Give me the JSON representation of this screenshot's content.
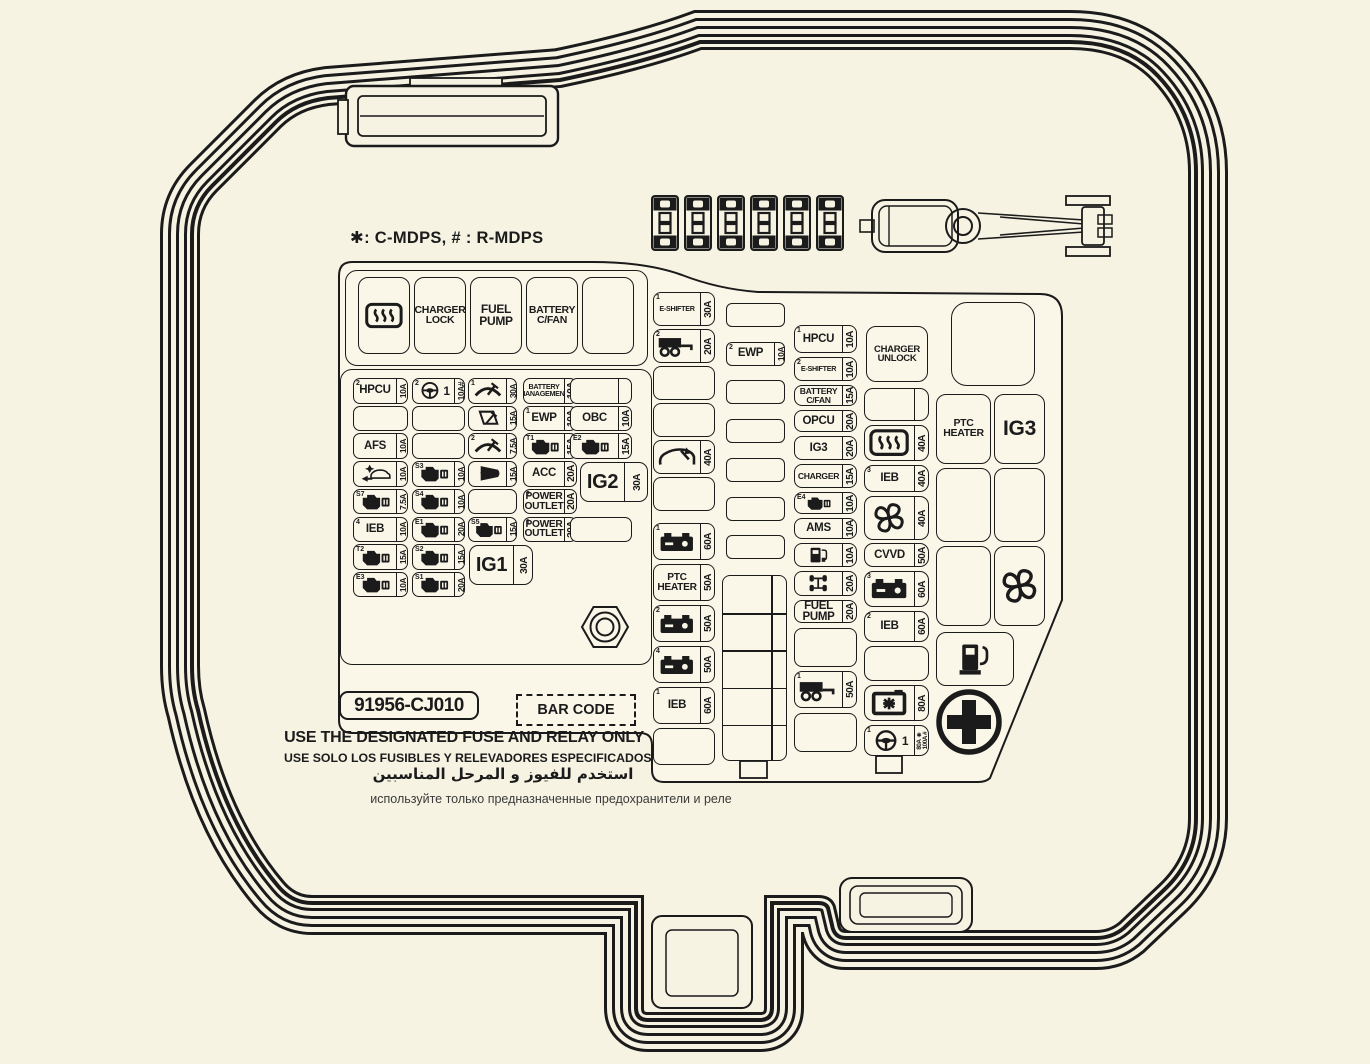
{
  "legend": "✱:  C-MDPS, # : R-MDPS",
  "colors": {
    "background": "#f6f3e3",
    "panel": "#faf7e9",
    "line": "#1b1b1b"
  },
  "hardware": {
    "spare_fuses": 6,
    "has_fuse_puller": true
  },
  "relay_row": [
    {
      "icon": "defrost-icon"
    },
    {
      "label": "CHARGER\nLOCK"
    },
    {
      "label": "FUEL\nPUMP"
    },
    {
      "label": "BATTERY\nC/FAN"
    },
    null
  ],
  "left_grid": {
    "rows": [
      [
        {
          "sup": "2",
          "label": "HPCU",
          "amp": "10A"
        },
        {
          "sup": "2",
          "icon": "steering-wheel-icon",
          "text": "1",
          "amp": "10A#"
        },
        {
          "sup": "1",
          "icon": "wiper-icon",
          "amp": "30A"
        },
        {
          "label": "BATTERY\nMANAGEMENT",
          "amp": "10A"
        },
        {
          "div": true
        }
      ],
      [
        null,
        null,
        {
          "icon": "rear-wiper-icon",
          "amp": "15A"
        },
        {
          "sup": "1",
          "label": "EWP",
          "amp": "10A"
        },
        {
          "label": "OBC",
          "amp": "10A"
        }
      ],
      [
        {
          "label": "AFS",
          "amp": "10A"
        },
        null,
        {
          "sup": "2",
          "icon": "wiper-icon",
          "amp": "7.5A"
        },
        {
          "sup": "T1",
          "icon": "ecu-icon",
          "amp": "15A"
        },
        {
          "sup": "E2",
          "icon": "ecu-icon",
          "amp": "15A"
        }
      ],
      [
        {
          "icon": "aeb-icon",
          "amp": "10A"
        },
        {
          "sup": "S3",
          "icon": "ecu-icon",
          "amp": "10A"
        },
        {
          "icon": "horn-icon",
          "amp": "15A"
        },
        {
          "label": "ACC",
          "amp": "20A"
        },
        null
      ],
      [
        {
          "sup": "S7",
          "icon": "ecu-icon",
          "amp": "7.5A"
        },
        {
          "sup": "S4",
          "icon": "ecu-icon",
          "amp": "10A"
        },
        null,
        {
          "sup": "2",
          "label": "POWER\nOUTLET",
          "amp": "20A"
        },
        null
      ],
      [
        {
          "sup": "4",
          "label": "IEB",
          "amp": "10A"
        },
        {
          "sup": "E1",
          "icon": "ecu-icon",
          "amp": "20A"
        },
        {
          "sup": "S5",
          "icon": "ecu-icon",
          "amp": "15A"
        },
        {
          "sup": "1",
          "label": "POWER\nOUTLET",
          "amp": "20A"
        },
        null
      ],
      [
        {
          "sup": "T2",
          "icon": "ecu-icon",
          "amp": "15A"
        },
        {
          "sup": "S2",
          "icon": "ecu-icon",
          "amp": "15A"
        },
        null,
        null,
        null
      ],
      [
        {
          "sup": "E3",
          "icon": "ecu-icon",
          "amp": "10A"
        },
        {
          "sup": "S1",
          "icon": "ecu-icon",
          "amp": "20A"
        },
        null,
        null,
        null
      ]
    ]
  },
  "ig1": {
    "label": "IG1",
    "amp": "30A"
  },
  "ig2": {
    "label": "IG2",
    "amp": "30A"
  },
  "mid_big": [
    {
      "sup": "1",
      "label": "E-SHIFTER",
      "amp": "30A"
    },
    {
      "sup": "2",
      "icon": "trailer-icon",
      "amp": "20A"
    },
    null,
    null,
    {
      "icon": "liftgate-icon",
      "amp": "40A"
    },
    null,
    {
      "sup": "1",
      "icon": "battery-icon",
      "amp": "60A"
    },
    {
      "label": "PTC\nHEATER",
      "amp": "50A"
    },
    {
      "sup": "2",
      "icon": "battery-icon",
      "amp": "50A"
    },
    {
      "sup": "4",
      "icon": "battery-icon",
      "amp": "50A"
    },
    {
      "sup": "1",
      "label": "IEB",
      "amp": "60A"
    },
    null
  ],
  "mid_small": [
    null,
    {
      "sup": "2",
      "label": "EWP",
      "amp": "10A"
    },
    null,
    null,
    null,
    null,
    null
  ],
  "mid_table": {
    "rows": 5,
    "cols": 2
  },
  "col_a": [
    {
      "sup": "1",
      "label": "HPCU",
      "amp": "10A"
    },
    {
      "sup": "2",
      "label": "E-SHIFTER",
      "amp": "10A"
    },
    {
      "label": "BATTERY\nC/FAN",
      "amp": "15A"
    },
    {
      "label": "OPCU",
      "amp": "20A"
    },
    {
      "label": "IG3",
      "amp": "20A"
    },
    {
      "label": "CHARGER",
      "amp": "15A"
    },
    {
      "sup": "E4",
      "icon": "ecu-icon",
      "amp": "10A"
    },
    {
      "label": "AMS",
      "amp": "10A"
    },
    {
      "icon": "ev-charger-icon",
      "amp": "10A"
    },
    {
      "icon": "awd-icon",
      "amp": "20A"
    },
    {
      "label": "FUEL\nPUMP",
      "amp": "20A"
    },
    null,
    {
      "sup": "1",
      "icon": "trailer-icon",
      "amp": "50A"
    },
    null
  ],
  "charger_unlock": {
    "label": "CHARGER\nUNLOCK"
  },
  "col_b": [
    {
      "div": true
    },
    {
      "icon": "defrost-icon",
      "amp": "40A"
    },
    {
      "sup": "3",
      "label": "IEB",
      "amp": "40A"
    },
    {
      "icon": "fan-icon",
      "amp": "40A"
    },
    {
      "label": "CVVD",
      "amp": "50A"
    },
    {
      "sup": "3",
      "icon": "battery-icon",
      "amp": "60A"
    },
    {
      "sup": "2",
      "label": "IEB",
      "amp": "60A"
    },
    null,
    {
      "icon": "battery-star-icon",
      "amp": "80A"
    },
    {
      "sup": "1",
      "icon": "steering-wheel-icon",
      "text": "1",
      "amp": "80A ✱",
      "amp2": "100A #"
    }
  ],
  "right_area": {
    "grid": [
      [
        {
          "label": "PTC\nHEATER"
        },
        {
          "label": "IG3",
          "big": true
        }
      ],
      [
        null,
        null
      ],
      [
        null,
        {
          "icon": "fan-icon"
        }
      ]
    ],
    "fuel_icon": "fuelpump-icon",
    "plus_icon": "plus-circle-icon"
  },
  "footer": {
    "part_number": "91956-CJ010",
    "barcode": "BAR CODE",
    "notice_en": "USE THE DESIGNATED FUSE AND RELAY ONLY",
    "notice_es": "USE SOLO LOS FUSIBLES Y RELEVADORES ESPECIFICADOS",
    "notice_ar": "استخدم للفيوز و المرحل المناسبين",
    "notice_ru": "используйте только предназначенные предохранители и реле"
  }
}
